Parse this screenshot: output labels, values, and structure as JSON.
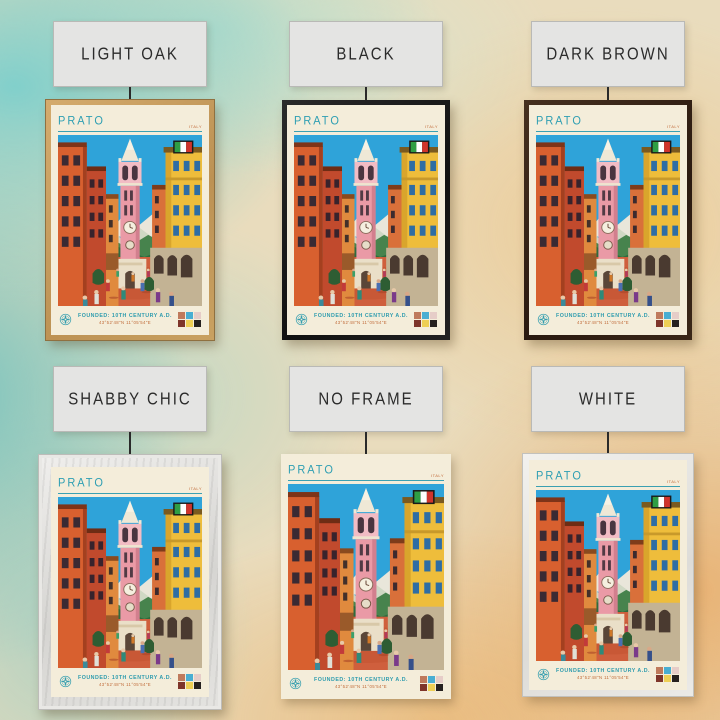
{
  "product": {
    "poster_city": "Prato travel poster",
    "variants": [
      {
        "id": "light-oak",
        "label": "LIGHT OAK"
      },
      {
        "id": "black",
        "label": "BLACK"
      },
      {
        "id": "dark-brown",
        "label": "DARK BROWN"
      },
      {
        "id": "shabby-chic",
        "label": "SHABBY CHIC"
      },
      {
        "id": "no-frame",
        "label": "NO FRAME"
      },
      {
        "id": "white",
        "label": "WHITE"
      }
    ]
  },
  "poster": {
    "title": "PRATO",
    "country": "ITALY",
    "founded_line": "FOUNDED: 10TH CENTURY A.D.",
    "coordinates": "43°52'48\"N 11°05'54\"E",
    "icons": {
      "flag": "italy-flag",
      "compass": "compass-rose"
    },
    "swatches": [
      "#bf7a5c",
      "#49aed2",
      "#e6cdc8",
      "#7e352a",
      "#eecf55",
      "#26211f"
    ],
    "palette": {
      "poster_background": "#f4edda",
      "accent_teal": "#2f9fb3",
      "accent_orange": "#c06a38",
      "sky": "#2fa3d9",
      "tower_pink": "#ea9aa6",
      "building_orange": "#d8602f",
      "building_yellow": "#eebd3b",
      "street_terracotta": "#cf5f3d"
    },
    "frame_colors": {
      "light-oak": "#c49a5e",
      "black": "#1c1c1c",
      "dark-brown": "#342218",
      "shabby-chic": "#dedddb",
      "white": "#ebebe8"
    }
  }
}
